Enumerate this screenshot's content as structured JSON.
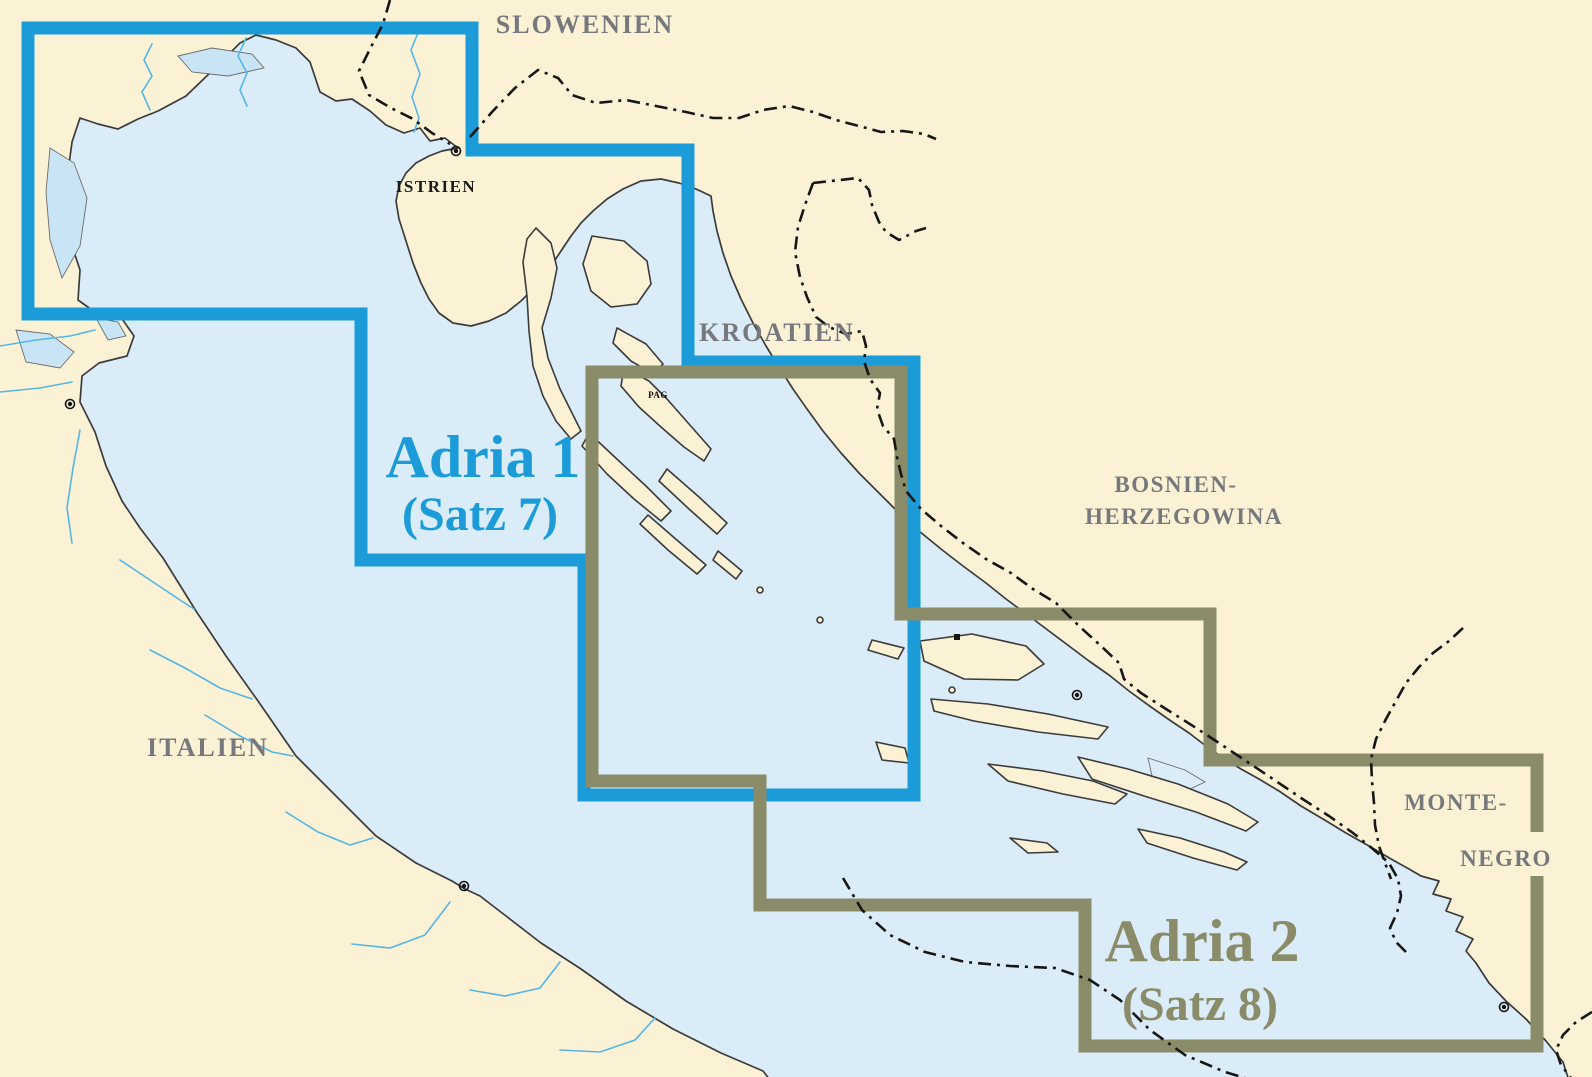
{
  "map_title": "Adriatic chart coverage map",
  "labels": {
    "slovenia": "SLOWENIEN",
    "istria": "ISTRIEN",
    "croatia": "KROATIEN",
    "bosnia_line1": "BOSNIEN-",
    "bosnia_line2": "HERZEGOWINA",
    "italy": "ITALIEN",
    "montenegro_line1": "MONTE-",
    "montenegro_line2": "NEGRO",
    "pag_island": "PAG"
  },
  "regions": {
    "adria1": {
      "title": "Adria 1",
      "subtitle": "(Satz 7)",
      "color": "#1B9CD9"
    },
    "adria2": {
      "title": "Adria 2",
      "subtitle": "(Satz 8)",
      "color": "#8A8B69"
    }
  },
  "colors": {
    "land": "#FBF2D6",
    "sea_light": "#D9ECF8",
    "sea_medium": "#BAE0F5",
    "sea_deep": "#A9D6EF",
    "sea_open": "#FFFFFF",
    "contour_line": "#55B5E5",
    "coastline": "#3B3B3B",
    "country_label": "#77787C",
    "border_adria1": "#1B9CD9",
    "border_adria2": "#8A8B69",
    "national_border": "#161616"
  },
  "icons": {
    "city_marker": "circle-with-dot",
    "town_marker": "filled-square"
  }
}
